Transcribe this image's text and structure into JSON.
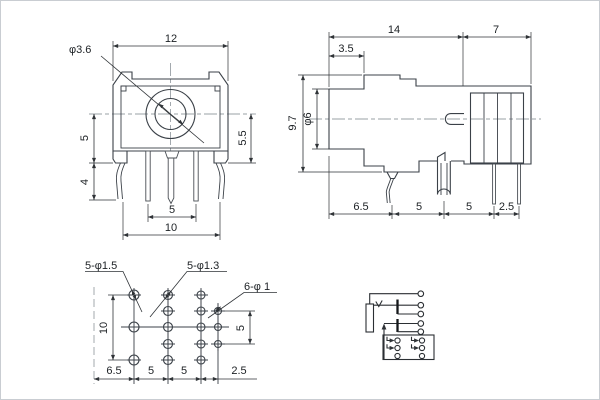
{
  "front": {
    "dia_label": "φ3.6",
    "width": "12",
    "left_upper": "5",
    "left_lower": "4",
    "right_height": "5.5",
    "pin_pitch": "5",
    "pin_span": "10"
  },
  "side": {
    "len": "14",
    "rear": "7",
    "step": "3.5",
    "height": "9.7",
    "barrel_dia": "φ6",
    "p1": "6.5",
    "p2": "5",
    "p3": "5",
    "p4": "2.5"
  },
  "footprint": {
    "holes_large": "5-φ1.5",
    "holes_mid": "5-φ1.3",
    "holes_small": "6-φ 1",
    "col_span": "10",
    "row_half": "5",
    "p1": "6.5",
    "p2": "5",
    "p3": "5",
    "p4": "2.5"
  }
}
